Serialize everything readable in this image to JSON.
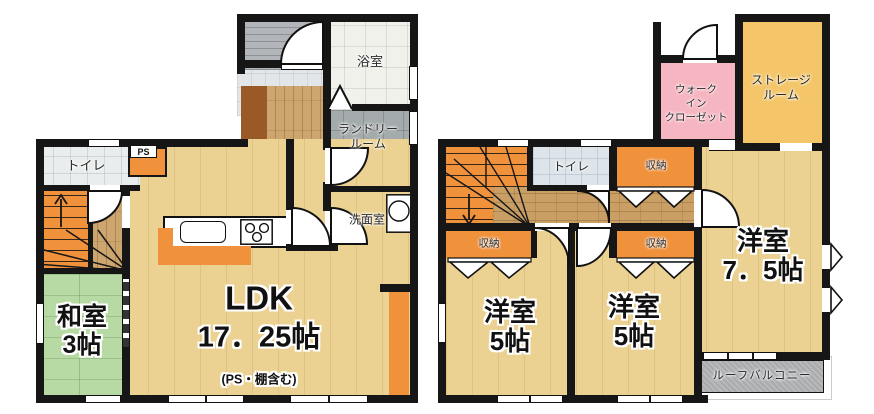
{
  "floor1": {
    "bath": "浴室",
    "laundry_line1": "ランドリー",
    "laundry_line2": "ルーム",
    "toilet": "トイレ",
    "ps": "PS",
    "washroom": "洗面室",
    "ldk_title": "LDK",
    "ldk_size": "17．25帖",
    "ldk_note": "(PS・棚含む)",
    "washitsu_title": "和室",
    "washitsu_size": "3帖"
  },
  "floor2": {
    "wic_line1": "ウォーク",
    "wic_line2": "イン",
    "wic_line3": "クローゼット",
    "storage_line1": "ストレージ",
    "storage_line2": "ルーム",
    "toilet": "トイレ",
    "closet": "収納",
    "western7_title": "洋室",
    "western7_size": "7．5帖",
    "western5_title": "洋室",
    "western5_size": "5帖",
    "roof_balcony": "ルーフバルコニー"
  },
  "palette": {
    "wall": "#161616",
    "floor_tan": "#ecd292",
    "hall_wood": "#cda56e",
    "tatami_green": "#b7d9a4",
    "accent_orange": "#f0913c",
    "wic_pink": "#f6b6c1",
    "storage_yellow": "#f4c669",
    "laundry_gray": "#a4abad",
    "balcony_gray": "#b7b9bb"
  }
}
